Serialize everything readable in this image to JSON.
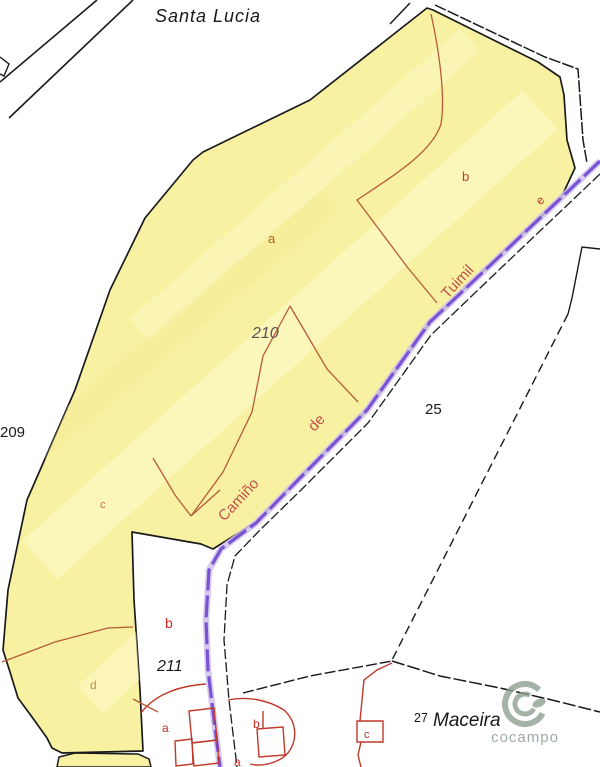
{
  "labels": {
    "santa_lucia": "Santa Lucia",
    "p209": "209",
    "p210": "210",
    "p211": "211",
    "p25": "25",
    "p27": "27",
    "maceira": "Maceira"
  },
  "road_name": {
    "w1": "Camiño",
    "w2": "de",
    "w3": "Tuimil"
  },
  "subparcels": {
    "a": "a",
    "b": "b",
    "c": "c",
    "d": "d",
    "e": "e",
    "p211_b": "b",
    "bld_a1": "a",
    "bld_b": "b",
    "bld_a2": "a",
    "maceira_c": "c"
  },
  "watermark": {
    "brand": "cocampo"
  },
  "colors": {
    "parcel_fill": "#f8f1a2",
    "parcel_fill_light": "#fdf9cd",
    "boundary_black": "#1a1a1a",
    "subdivision_red": "#b65c38",
    "label_red": "#c53b28",
    "road_purple": "#7a52d4",
    "road_halo": "#cfc2ec",
    "road_text_red": "#c2514a",
    "watermark_green": "#93a294"
  }
}
